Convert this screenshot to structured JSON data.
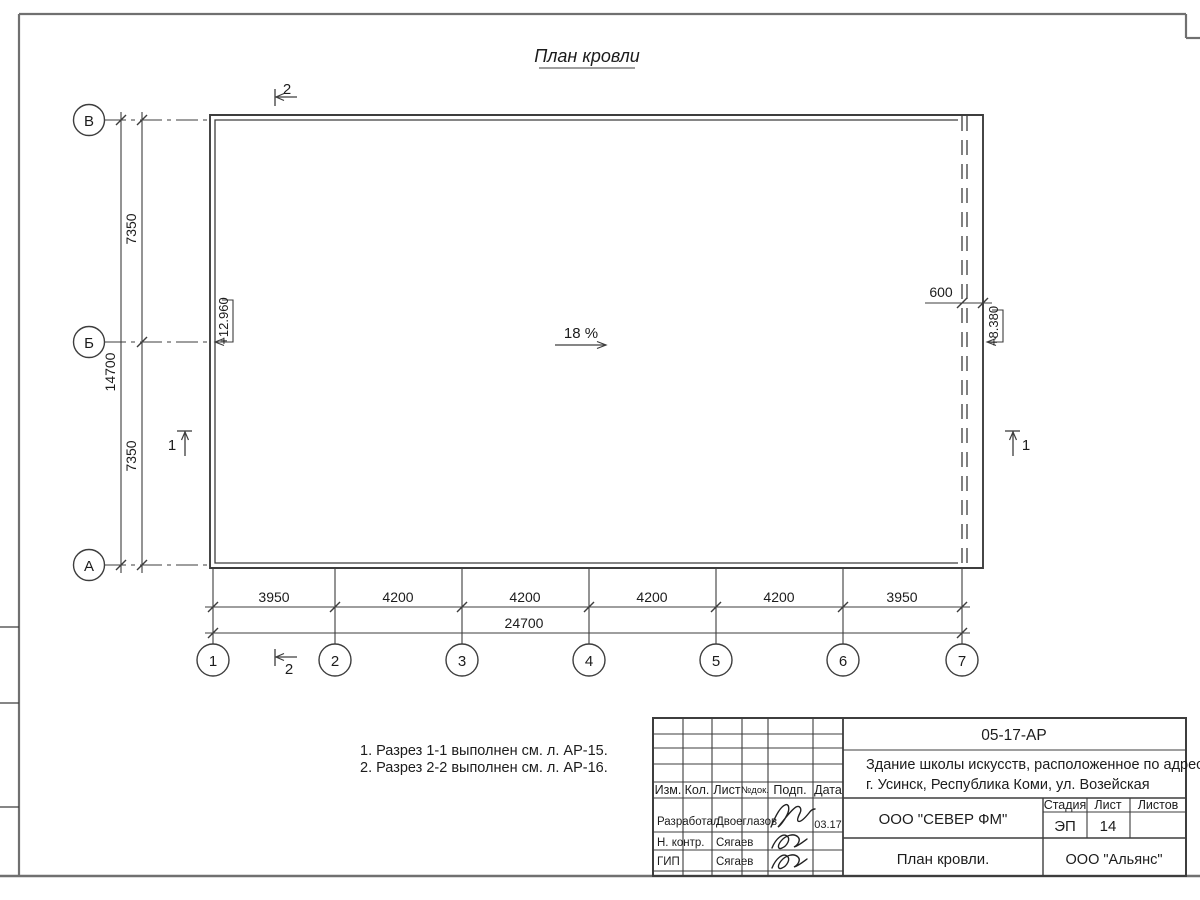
{
  "page": {
    "title": "План кровли"
  },
  "plan": {
    "slope_label": "18 %",
    "elevation_left": "+12.960",
    "elevation_right": "+8.380",
    "overhang_dim": "600"
  },
  "grid": {
    "rows": [
      "В",
      "Б",
      "А"
    ],
    "cols": [
      "1",
      "2",
      "3",
      "4",
      "5",
      "6",
      "7"
    ]
  },
  "dims": {
    "v_segments": [
      "7350",
      "7350"
    ],
    "v_total": "14700",
    "h_segments": [
      "3950",
      "4200",
      "4200",
      "4200",
      "4200",
      "3950"
    ],
    "h_total": "24700"
  },
  "sections": {
    "mark1": "1",
    "mark2": "2"
  },
  "notes": [
    "1. Разрез 1-1 выполнен см. л. АР-15.",
    "2. Разрез 2-2 выполнен см. л. АР-16."
  ],
  "stamp": {
    "doc_number": "05-17-АР",
    "address1": "Здание школы искусств, расположенное по адресу:",
    "address2": "г. Усинск, Республика Коми, ул. Возейская",
    "col_izm": "Изм.",
    "col_kol": "Кол.",
    "col_list": "Лист",
    "col_ndok": "№док.",
    "col_podp": "Подп.",
    "col_data": "Дата",
    "row1_role": "Разработал",
    "row1_name": "Двоеглазов",
    "row1_date": "03.17",
    "row2_role": "Н. контр.",
    "row2_name": "Сягаев",
    "row3_role": "ГИП",
    "row3_name": "Сягаев",
    "stage_label": "Стадия",
    "sheet_label": "Лист",
    "sheets_label": "Листов",
    "stage_value": "ЭП",
    "sheet_value": "14",
    "sheets_value": "",
    "company": "ООО \"СЕВЕР ФМ\"",
    "drawing_name": "План кровли.",
    "org": "ООО \"Альянс\""
  }
}
